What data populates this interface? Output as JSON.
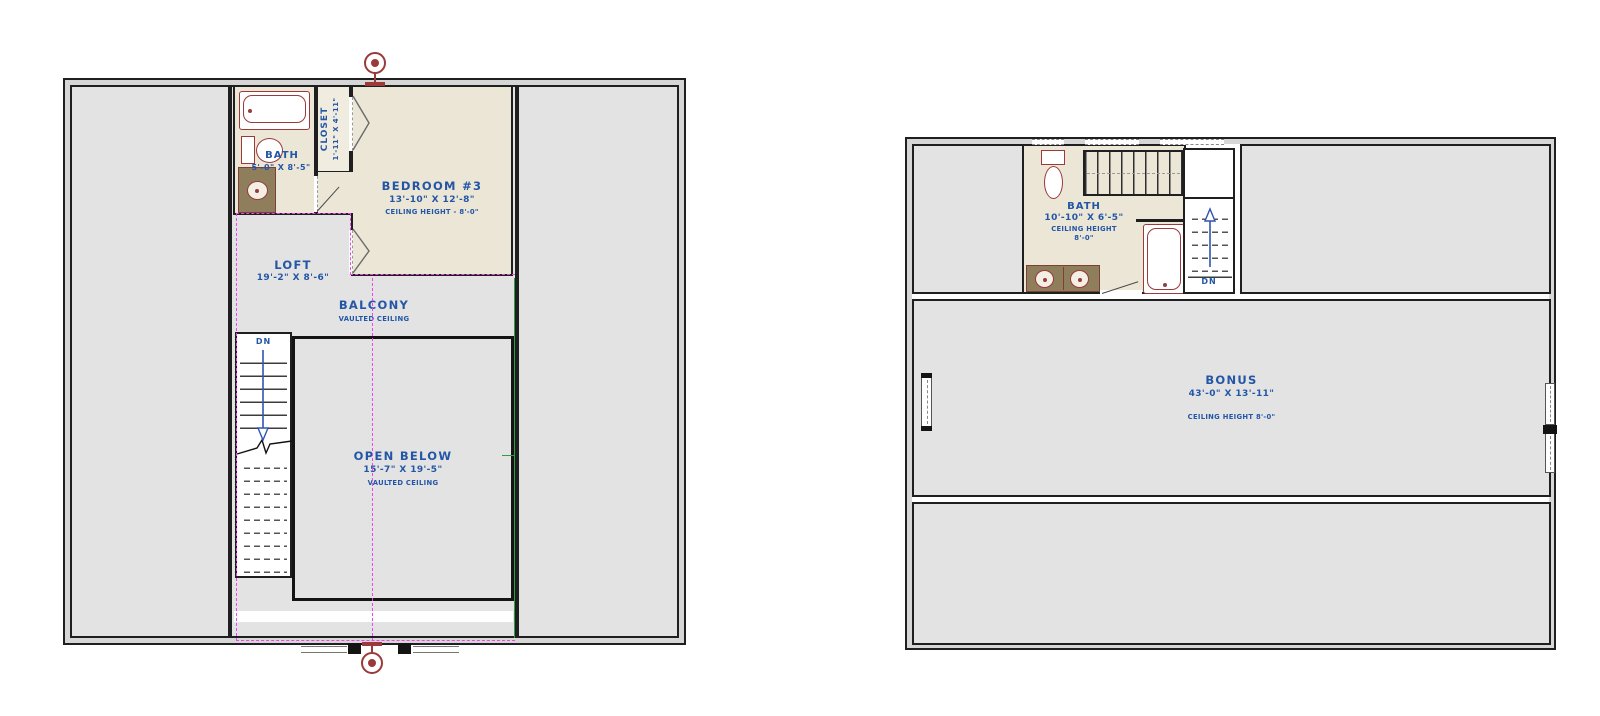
{
  "drawing": "second floor / bonus floor plans",
  "colors": {
    "label_blue": "#2456a6",
    "fixture_red": "#9a3a3a",
    "vanity_olive": "#8e7e5c",
    "floor_cream": "#ebe6d6",
    "floor_grey": "#e3e3e3",
    "wall": "#1f1f1f",
    "centerline_magenta": "#ee44ee",
    "edge_green": "#2f9e42"
  },
  "left": {
    "bath": {
      "name": "BATH",
      "dims": "5'-0\" X 8'-5\""
    },
    "closet": {
      "name": "CLOSET",
      "dims": "1'-11\" X 4'-11\""
    },
    "bedroom": {
      "name": "BEDROOM #3",
      "dims": "13'-10\" X 12'-8\"",
      "ceiling": "CEILING HEIGHT - 8'-0\""
    },
    "loft": {
      "name": "LOFT",
      "dims": "19'-2\" X 8'-6\""
    },
    "balcony": {
      "name": "BALCONY",
      "ceiling": "VAULTED CEILING"
    },
    "open_below": {
      "name": "OPEN BELOW",
      "dims": "15'-7\" X 19'-5\"",
      "ceiling": "VAULTED CEILING"
    },
    "stairs": {
      "dn": "DN"
    }
  },
  "right": {
    "bath": {
      "name": "BATH",
      "dims": "10'-10\" X 6'-5\"",
      "ceiling_line1": "CEILING HEIGHT",
      "ceiling_line2": "8'-0\""
    },
    "bonus": {
      "name": "BONUS",
      "dims": "43'-0\" X 13'-11\"",
      "ceiling": "CEILING HEIGHT 8'-0\""
    },
    "stairs": {
      "dn": "DN"
    }
  }
}
